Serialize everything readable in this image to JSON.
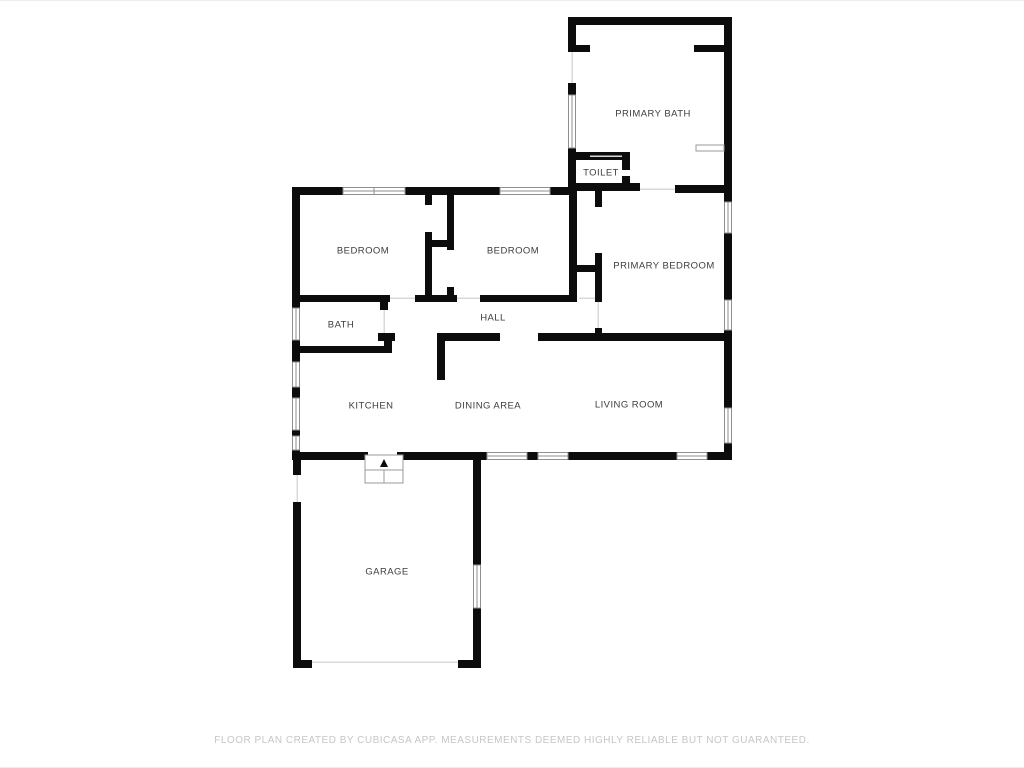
{
  "plan": {
    "rooms": [
      {
        "id": "primary-bath",
        "label": "PRIMARY BATH"
      },
      {
        "id": "toilet",
        "label": "TOILET"
      },
      {
        "id": "bedroom-1",
        "label": "BEDROOM"
      },
      {
        "id": "bedroom-2",
        "label": "BEDROOM"
      },
      {
        "id": "primary-bedroom",
        "label": "PRIMARY BEDROOM"
      },
      {
        "id": "bath",
        "label": "BATH"
      },
      {
        "id": "hall",
        "label": "HALL"
      },
      {
        "id": "kitchen",
        "label": "KITCHEN"
      },
      {
        "id": "dining-area",
        "label": "DINING AREA"
      },
      {
        "id": "living-room",
        "label": "LIVING ROOM"
      },
      {
        "id": "garage",
        "label": "GARAGE"
      }
    ],
    "footer": "FLOOR PLAN CREATED BY CUBICASA APP. MEASUREMENTS DEEMED HIGHLY RELIABLE BUT NOT GUARANTEED."
  },
  "colors": {
    "wall": "#0c0c0c",
    "window_stroke": "#8f8f8f",
    "door_line": "#d9d9d9",
    "label_text": "#3d3d3d",
    "footer_text": "#c6c6c6",
    "background": "#ffffff"
  }
}
